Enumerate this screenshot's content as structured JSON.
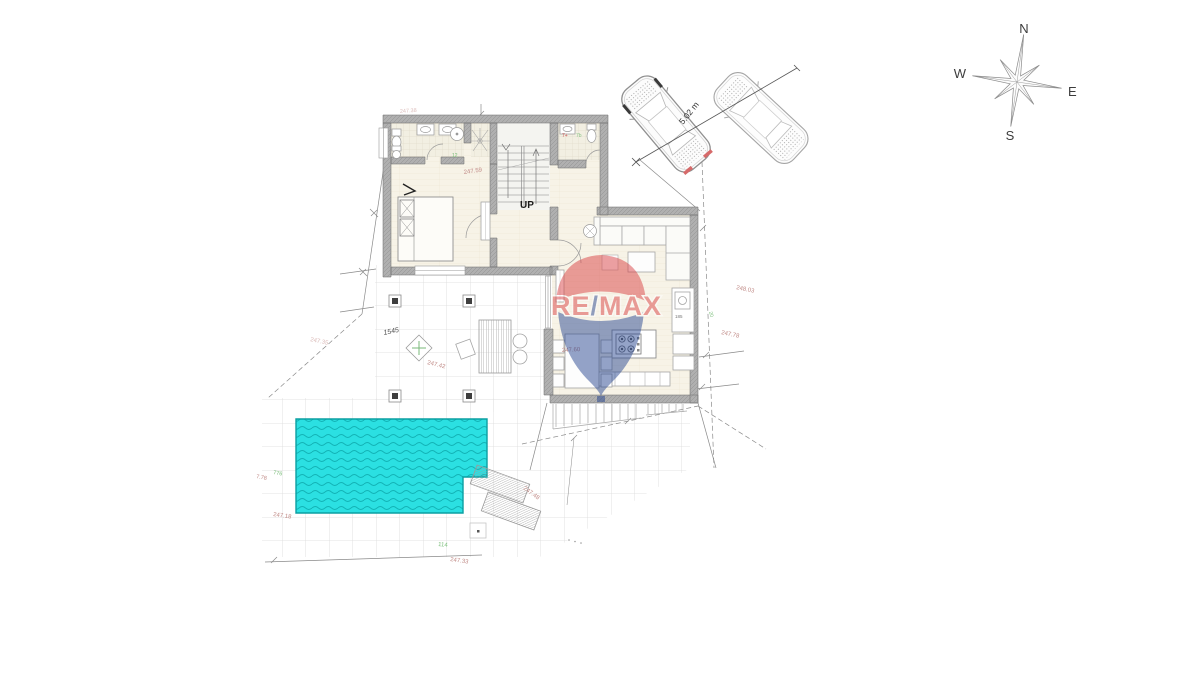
{
  "colors": {
    "pool": "#2be0e2",
    "pool_wave": "#12b2b5",
    "wall": "#b0b0b0",
    "grid": "#dadada",
    "dim_text": "#c08a86",
    "green_text": "#79bd79",
    "remax_red": "#d93b3e",
    "remax_blue": "#21418e"
  },
  "compass": {
    "n": "N",
    "e": "E",
    "s": "S",
    "w": "W"
  },
  "plan": {
    "up": "UP",
    "kitchen_note": "185"
  },
  "watermark": {
    "re": "RE",
    "slash": "/",
    "max": "MAX"
  },
  "dims": {
    "car": "5.02 m",
    "top": "247.38",
    "hall": "247.59",
    "right_upper": "248.03",
    "right_lower": "247.78",
    "dining": "247.60",
    "terrace": "247.42",
    "terrace_left": "247.35",
    "site": "1545",
    "loungers": "247.48",
    "pool_bottom": "247.33",
    "pool_left": "247.18",
    "west": "7.78"
  },
  "greens": {
    "g776": "776",
    "g114": "114",
    "g12": "12",
    "g20": "20",
    "g7b": "7b"
  },
  "reds": {
    "r7": "7+"
  }
}
